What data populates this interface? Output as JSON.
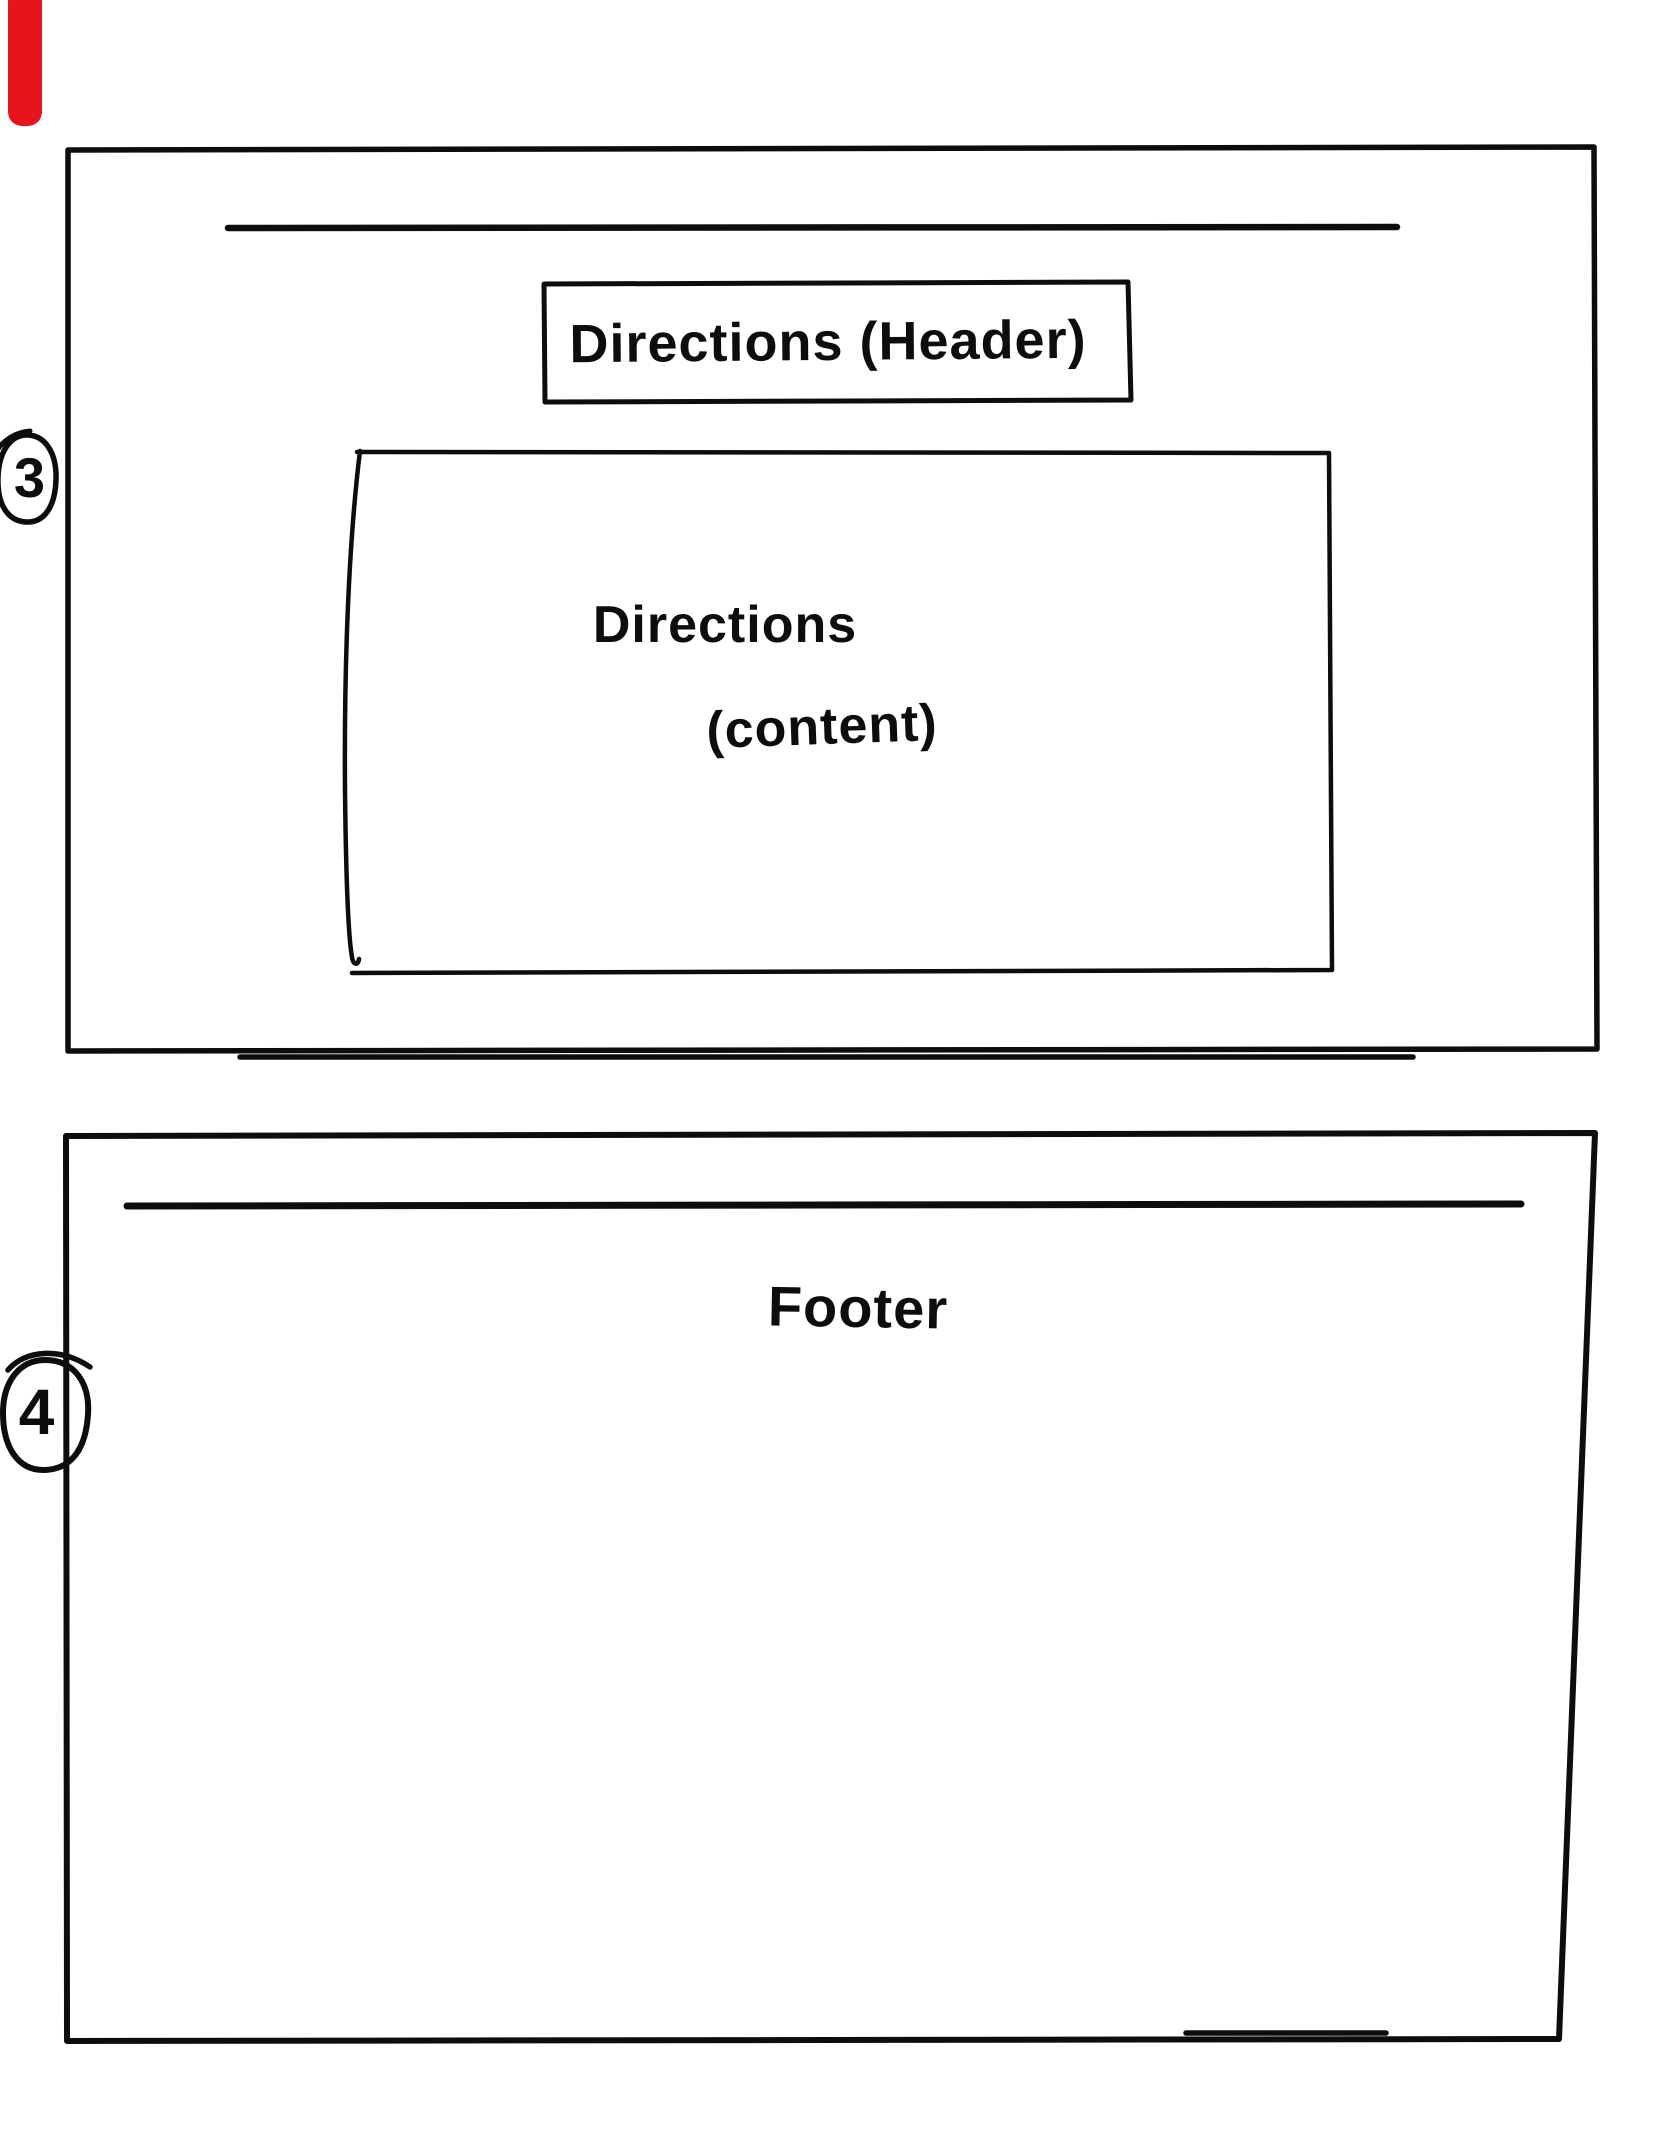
{
  "colors": {
    "ink": "#0d0d0d",
    "paper": "#ffffff",
    "marker_red": "#e8141c"
  },
  "slides": [
    {
      "number": "3",
      "header_label": "Directions (Header)",
      "content_label_line1": "Directions",
      "content_label_line2": "(content)"
    },
    {
      "number": "4",
      "footer_label": "Footer"
    }
  ]
}
